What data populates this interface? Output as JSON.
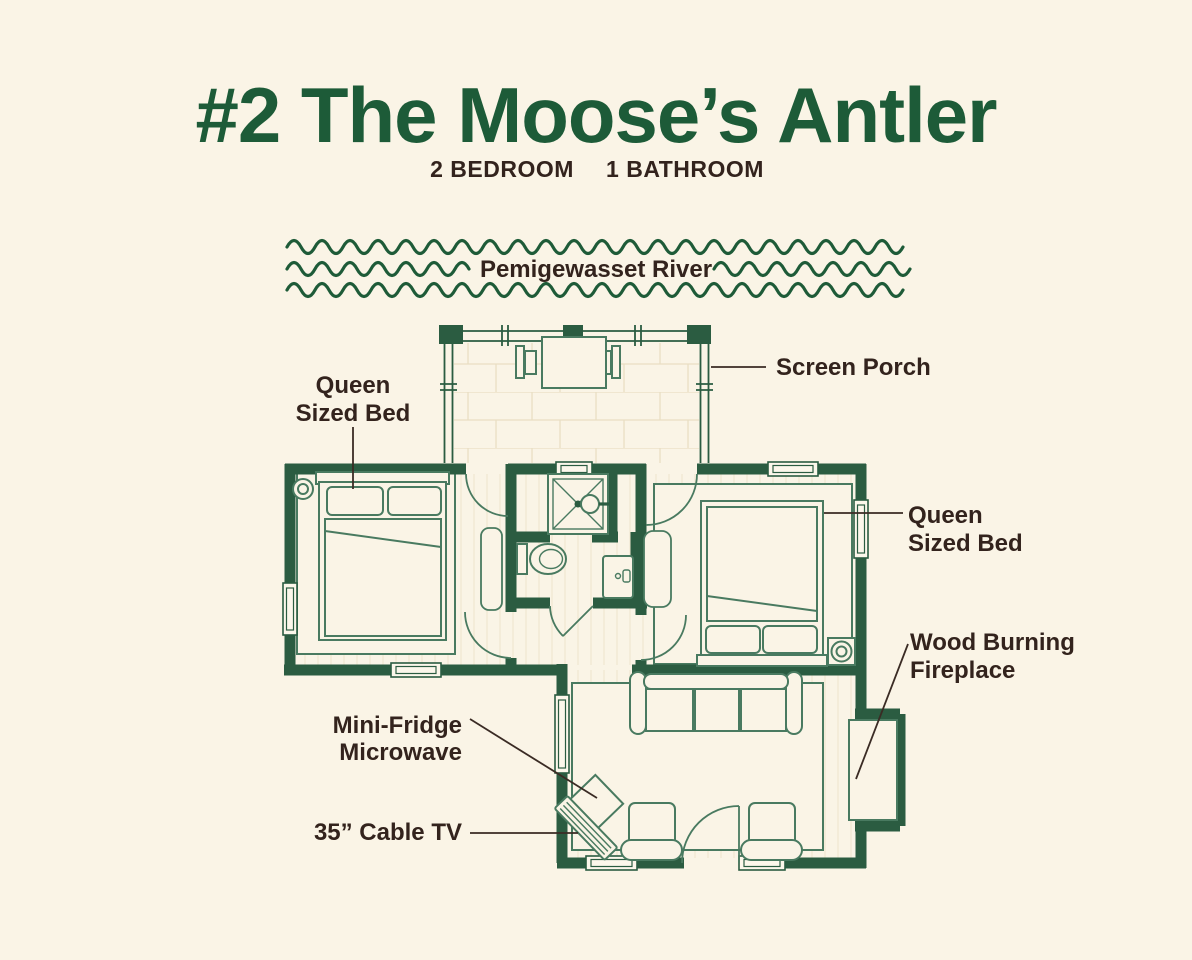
{
  "title": "#2 The Moose’s Antler",
  "subtitle": {
    "bedrooms": "2 BEDROOM",
    "bathrooms": "1 BATHROOM"
  },
  "river": {
    "name": "Pemigewasset River"
  },
  "labels": {
    "screen_porch": "Screen Porch",
    "bed_left": {
      "line1": "Queen",
      "line2": "Sized Bed"
    },
    "bed_right": {
      "line1": "Queen",
      "line2": "Sized Bed"
    },
    "fireplace": {
      "line1": "Wood Burning",
      "line2": "Fireplace"
    },
    "kitchenette": {
      "line1": "Mini-Fridge",
      "line2": "Microwave"
    },
    "tv": "35” Cable TV"
  },
  "colors": {
    "background": "#FAF4E6",
    "title_green": "#1D5B38",
    "wall_green": "#2B5C41",
    "furniture_green": "#497A60",
    "label_text": "#33231D",
    "leader_line": "#3A2B24",
    "floor_line": "#EDE2C8"
  }
}
